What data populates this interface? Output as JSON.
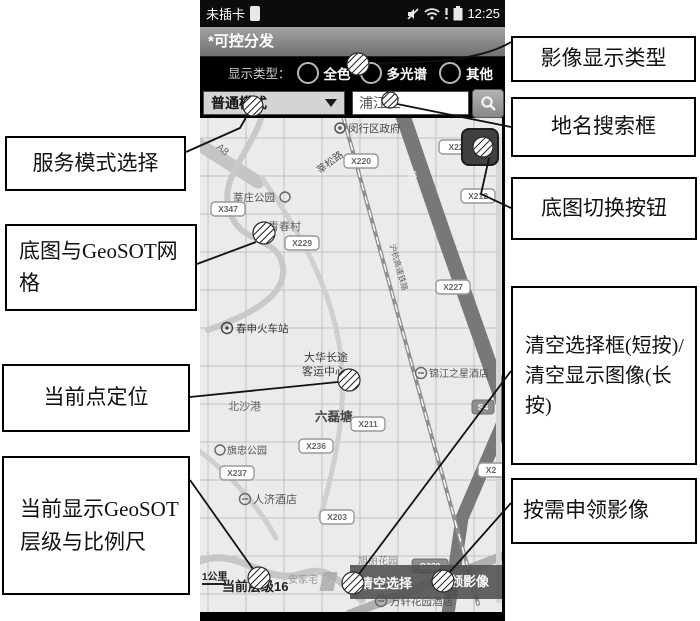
{
  "colors": {
    "phone_bar": "#000000",
    "title_bar": "#8c8c8c",
    "map_bg": "#ebebeb",
    "button_bar": "#4f4f4f"
  },
  "callouts": {
    "left": [
      {
        "label": "服务模式选择"
      },
      {
        "label": "底图与GeoSOT网格"
      },
      {
        "label": "当前点定位"
      },
      {
        "label": "当前显示GeoSOT层级与比例尺"
      }
    ],
    "right": [
      {
        "label": "影像显示类型"
      },
      {
        "label": "地名搜索框"
      },
      {
        "label": "底图切换按钮"
      },
      {
        "label": "清空选择框(短按)/清空显示图像(长按)"
      },
      {
        "label": "按需申领影像"
      }
    ]
  },
  "phone": {
    "status_bar": {
      "carrier": "未插卡",
      "time": "12:25"
    },
    "title": "*可控分发",
    "display_type": {
      "label": "显示类型：",
      "options": [
        {
          "label": "全色",
          "selected": false
        },
        {
          "label": "多光谱",
          "selected": true
        },
        {
          "label": "其他",
          "selected": false
        }
      ]
    },
    "mode_dropdown": {
      "value": "普通模式"
    },
    "search": {
      "value": "浦江三"
    },
    "map": {
      "labels": {
        "district_gov": "闵行区政府",
        "xinsong_road": "莘松路",
        "a8": "A8",
        "xinzhuang_park": "莘庄公园",
        "qingchun_village": "青春村",
        "chunshen_road": "春申",
        "railway": "沪杭高速铁路",
        "chunshen_station": "春申火车站",
        "bus_center_line1": "大华长途",
        "bus_center_line2": "客运中心",
        "jinjiang_inn": "锦江之星酒店",
        "beishagang": "北沙港",
        "liuleitang": "六磊塘",
        "qizhong_park": "旗忠公园",
        "renji_hotel": "人济酒店",
        "xuli_garden": "旭丽花园",
        "anjiazhai": "安家宅",
        "wanxuan_hotel": "万轩花园酒店"
      },
      "badges": {
        "x347": "X347",
        "x220": "X220",
        "x229": "X229",
        "x22": "X22",
        "x212": "X212",
        "x227": "X227",
        "x211": "X211",
        "x236": "X236",
        "x237": "X237",
        "x203": "X203",
        "g320": "G320",
        "s4": "S4",
        "x2": "X2"
      },
      "scale_label": "1公里",
      "level_label": "当前层级16",
      "buttons": {
        "clear": "清空选择",
        "request": "申领影像"
      }
    }
  }
}
